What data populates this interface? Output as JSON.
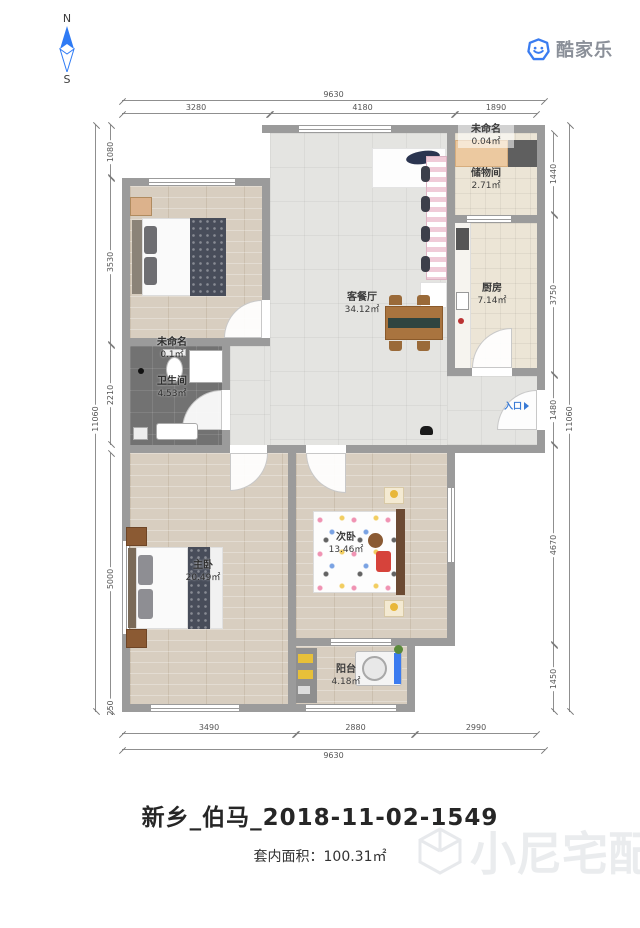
{
  "compass": {
    "north": "N",
    "south": "S"
  },
  "logo": {
    "text": "酷家乐"
  },
  "entrance_label": "入口",
  "rooms": {
    "living": {
      "name": "客餐厅",
      "area": "34.12㎡"
    },
    "kitchen": {
      "name": "厨房",
      "area": "7.14㎡"
    },
    "storage": {
      "name": "储物间",
      "area": "2.71㎡"
    },
    "unnamed_top": {
      "name": "未命名",
      "area": "0.04㎡"
    },
    "unnamed_bath": {
      "name": "未命名",
      "area": "0.1㎡"
    },
    "bathroom": {
      "name": "卫生间",
      "area": "4.53㎡"
    },
    "master": {
      "name": "主卧",
      "area": "20.49㎡"
    },
    "second": {
      "name": "次卧",
      "area": "13.46㎡"
    },
    "balcony": {
      "name": "阳台",
      "area": "4.18㎡"
    }
  },
  "dims": {
    "top": {
      "overall": "9630",
      "segments": [
        "3280",
        "4180",
        "1890"
      ]
    },
    "bottom": {
      "overall": "9630",
      "segments": [
        "3490",
        "2880",
        "2990"
      ]
    },
    "left": {
      "overall": "11060",
      "segments": [
        "1080",
        "3530",
        "2210",
        "5000",
        "250"
      ]
    },
    "right": {
      "overall": "11060",
      "segments": [
        "1440",
        "3750",
        "1480",
        "4670",
        "1450"
      ]
    }
  },
  "title": "新乡_伯马_2018-11-02-1549",
  "footer": {
    "area_label": "套内面积：",
    "area_value": "100.31㎡"
  },
  "watermark": "小尼宅配",
  "colors": {
    "accent_blue": "#3a7bd5",
    "wall_gray": "#9b9b9b"
  }
}
